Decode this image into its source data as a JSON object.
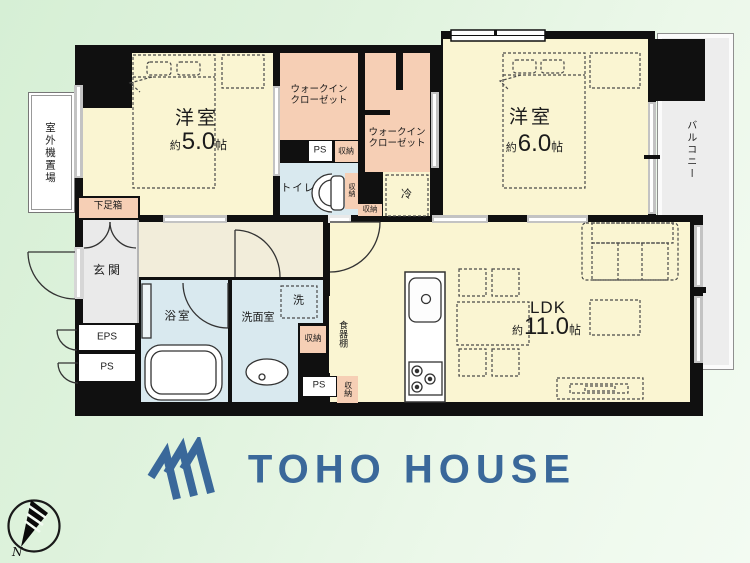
{
  "floor_plan": {
    "bedroom1": {
      "name": "洋室",
      "area_prefix": "約",
      "area_value": "5.0",
      "area_unit": "帖"
    },
    "bedroom2": {
      "name": "洋室",
      "area_prefix": "約",
      "area_value": "6.0",
      "area_unit": "帖"
    },
    "ldk": {
      "name": "LDK",
      "area_prefix": "約",
      "area_value": "11.0",
      "area_unit": "帖"
    },
    "walk_in_closet": {
      "line1": "ウォークイン",
      "line2": "クローゼット"
    },
    "labels": {
      "entrance": "玄関",
      "bathroom": "浴室",
      "washroom": "洗面室",
      "toilet": "トイレ",
      "balcony": "バルコニー",
      "outdoor_unit": "室外機置場",
      "shoe_box": "下足箱",
      "cupboard": "食器棚",
      "washer": "洗",
      "fridge": "冷",
      "eps": "EPS",
      "ps": "PS",
      "storage": "収納"
    }
  },
  "branding": {
    "logo_text": "TOHO HOUSE",
    "logo_color": "#3a689a"
  },
  "compass": {
    "north_label": "N"
  }
}
